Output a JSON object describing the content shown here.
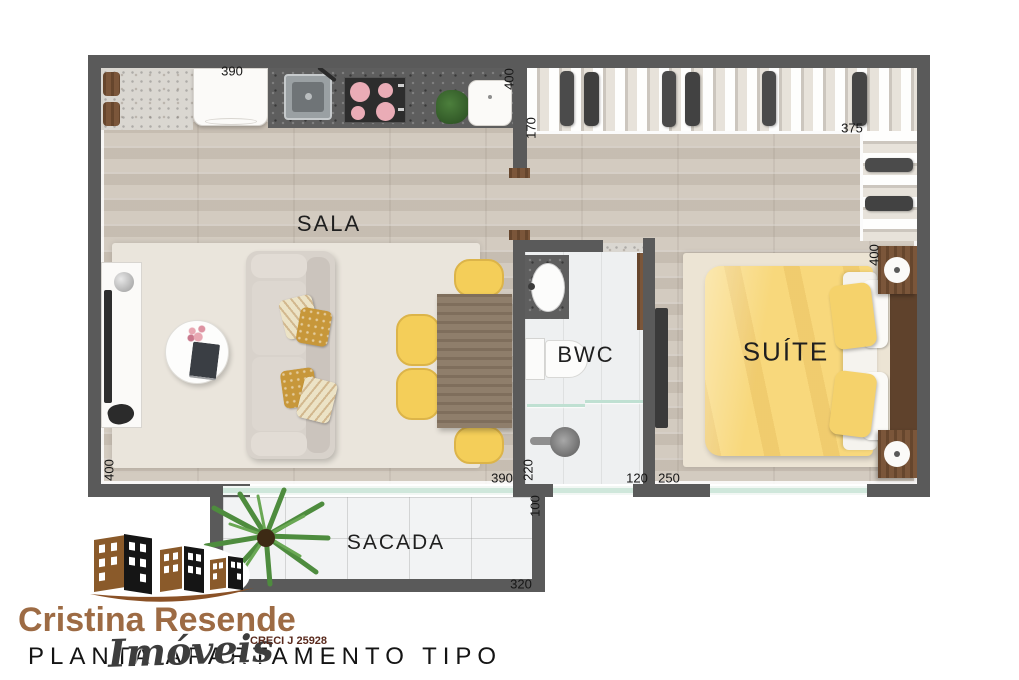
{
  "plan": {
    "rooms": {
      "sala": "SALA",
      "bwc": "BWC",
      "suite": "SUÍTE",
      "sacada": "SACADA"
    },
    "dimensions": {
      "d390_top": "390",
      "d400_service": "400",
      "d170_closet": "170",
      "d375_closet": "375",
      "d400_suite": "400",
      "d400_sala": "400",
      "d390_sala": "390",
      "d220_bwc": "220",
      "d120_bwc": "120",
      "d250_suite": "250",
      "d100_sacada": "100",
      "d320_sacada": "320"
    }
  },
  "branding": {
    "agency_name": "Cristina Resende",
    "agency_type": "Imóveis",
    "creci": "CRECI J 25928",
    "plan_title": "PLANTA APARTAMENTO TIPO"
  },
  "colors": {
    "brand_brown": "#9d6b44",
    "wall_gray": "#5a5a5a",
    "bed_yellow": "#f8d87c",
    "chair_yellow": "#f4ce59",
    "glass_green": "#cfe7db",
    "creci_maroon": "#5a2a1d"
  }
}
